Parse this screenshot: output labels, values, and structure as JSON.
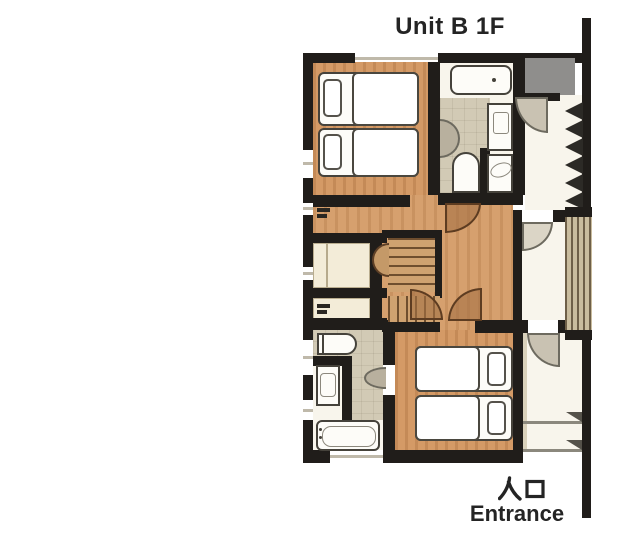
{
  "title": "Unit B 1F",
  "entrance": {
    "jp": "入口",
    "en": "Entrance"
  },
  "plan": {
    "type": "floor-plan",
    "rooms_visible": [
      "bedroom-top with 2 single beds",
      "bathroom-top with bathtub, vanity, toilet, washer",
      "entrance-hall with shoe-rack",
      "closets",
      "staircase",
      "bathroom-bottom with toilet, vanity, bathtub",
      "bedroom-bottom with 2 single beds",
      "entrance corridor with steps"
    ],
    "colors": {
      "wall": "#201d1a",
      "wood_floor": "#d49a66",
      "tile_floor": "#d2cab5",
      "closet": "#f3ecd8",
      "door_swing_brown": "#a57145",
      "door_swing_gray": "#c9c2b2",
      "text": "#242424"
    }
  }
}
